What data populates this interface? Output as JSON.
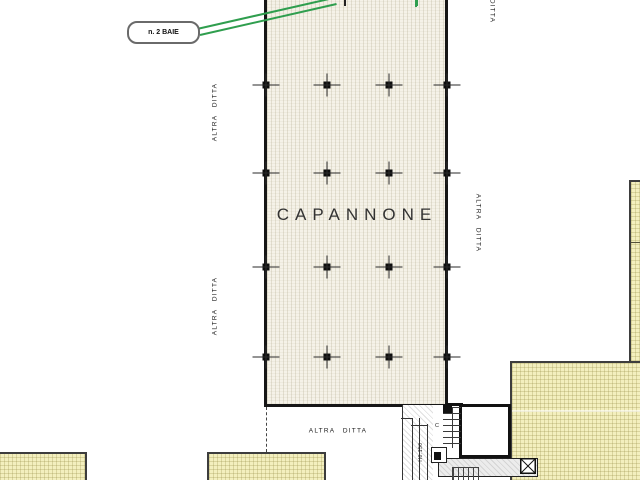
{
  "drawing": {
    "callout": {
      "label": "n. 2 BAIE"
    },
    "building": {
      "name": "CAPANNONE",
      "grid": {
        "columns_x": [
          266,
          327,
          389,
          447
        ],
        "rows_y": [
          85,
          173,
          267,
          357
        ],
        "top_ticks": [
          {
            "x": 344,
            "color": "#222222"
          },
          {
            "x": 416,
            "color": "#2f9e4e"
          }
        ]
      }
    },
    "neighbors": {
      "left_upper": "ALTRA DITTA",
      "left_lower": "ALTRA DITTA",
      "right": "ALTRA DITTA",
      "top_right": "DITTA",
      "bottom": "ALTRA DITTA"
    },
    "service_area": {
      "ramp_label": "H0:150",
      "stair_label": "C"
    },
    "colors": {
      "highlight_green": "#2f9e4e",
      "building_fill": "#f5f2e8",
      "surrounding_fill": "#f3efbe",
      "outline": "#1a1a1a"
    }
  }
}
